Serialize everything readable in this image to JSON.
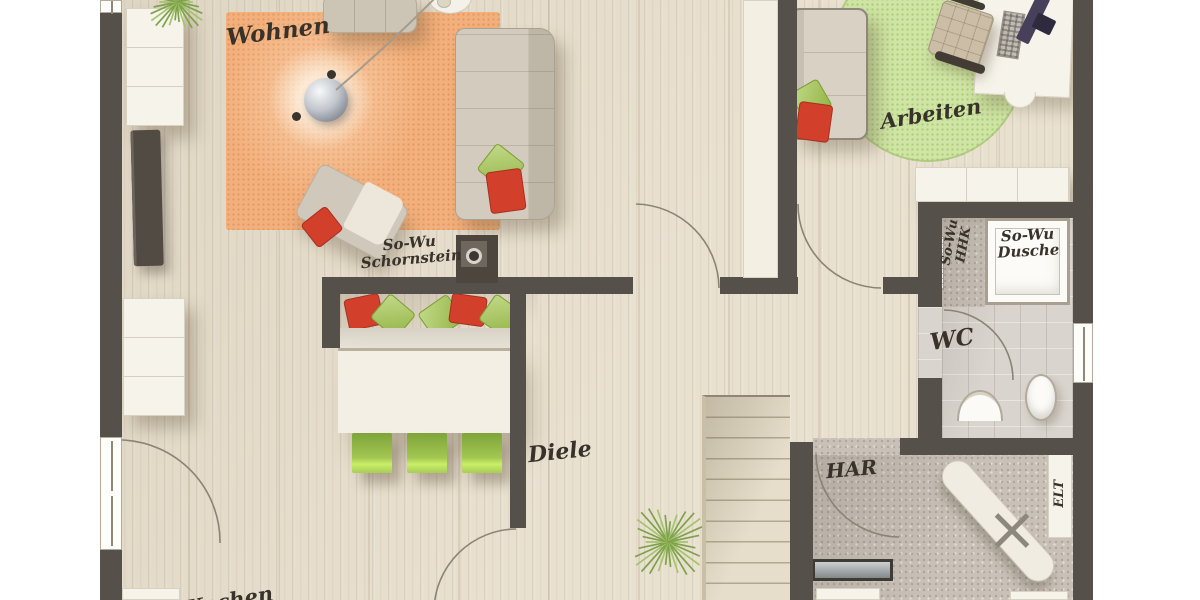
{
  "plan": {
    "type": "floor-plan-top-view",
    "labels": {
      "wohnen": "Wohnen",
      "arbeiten": "Arbeiten",
      "diele": "Diele",
      "wc": "WC",
      "har": "HAR",
      "elt": "ELT",
      "kochen": "Kochen",
      "schornstein_line1": "So-Wu",
      "schornstein_line2": "Schornstein",
      "dusche_line1": "So-Wu",
      "dusche_line2": "Dusche",
      "hhk_line1": "So-Wu",
      "hhk_line2": "HHK"
    },
    "palette": {
      "wall": "#56504a",
      "wood_floor": "#e9e1d0",
      "tile_floor": "#d9d4cd",
      "utility_floor": "#c9c1b7",
      "rug_orange": "#f3b07c",
      "rug_green": "#cfe5a4",
      "chair_green": "#a3c751",
      "pillow_red": "#d2402c",
      "pillow_green": "#a0c44a",
      "furniture_light": "#f6f3ea"
    }
  }
}
